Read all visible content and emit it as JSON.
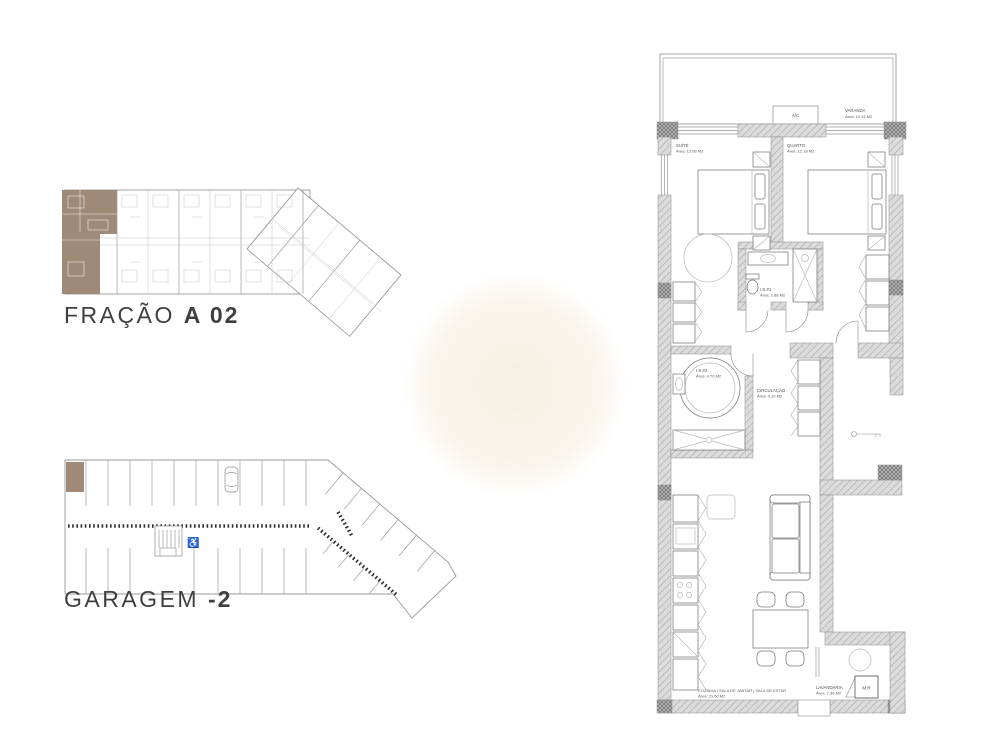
{
  "plans": {
    "fracao": {
      "title_regular": "FRAÇÃO",
      "title_bold": "A 02",
      "highlight_color": "#a18977"
    },
    "garagem": {
      "title_regular": "GARAGEM",
      "title_bold": "-2",
      "highlight_color": "#a18977"
    },
    "apartment": {
      "labels": {
        "ac": "A/C",
        "mr": "M.R"
      },
      "rooms": {
        "varanda": {
          "name": "VARANDA",
          "area": "Área: 10.31 M2"
        },
        "suite": {
          "name": "SUÍTE",
          "area": "Área: 12.06 M2"
        },
        "quarto": {
          "name": "QUARTO",
          "area": "Área: 12.18 M2"
        },
        "is1": {
          "name": "I.S.#1",
          "area": "Área: 2.88 M2"
        },
        "is2": {
          "name": "I.S.#2",
          "area": "Área: 4.70 M2"
        },
        "circulacao": {
          "name": "CIRCULAÇÃO",
          "area": "Área: 4.10 M2"
        },
        "cozinha": {
          "name": "COZINHA | SALA DE JANTAR | SALA DE ESTAR",
          "area": "Área: 21.50 M2"
        },
        "lavandaria": {
          "name": "LAVANDARIA",
          "area": "Área: 2.36 M2"
        }
      }
    }
  }
}
